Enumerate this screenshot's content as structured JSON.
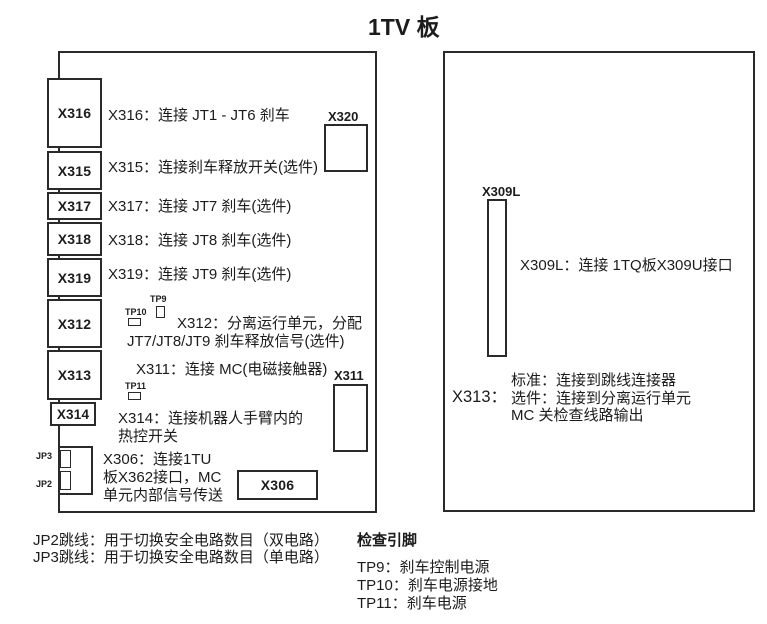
{
  "title": "1TV 板",
  "colors": {
    "line": "#2a2a2a",
    "text": "#1c1c1c",
    "background": "#ffffff"
  },
  "left_board": {
    "edge_connectors": [
      "X316",
      "X315",
      "X317",
      "X318",
      "X319",
      "X312",
      "X313",
      "X314"
    ],
    "other_connectors": [
      "X320",
      "X311",
      "X306"
    ],
    "descriptions": {
      "x316": "X316：连接 JT1 - JT6 刹车",
      "x315": "X315：连接刹车释放开关(选件)",
      "x317": "X317：连接 JT7 刹车(选件)",
      "x318": "X318：连接 JT8 刹车(选件)",
      "x319": "X319：连接 JT9 刹车(选件)",
      "x312_line1": "X312：分离运行单元，分配",
      "x312_line2": "JT7/JT8/JT9 刹车释放信号(选件)",
      "x311": "X311：连接 MC(电磁接触器)",
      "x314_line1": "X314：连接机器人手臂内的",
      "x314_line2": "热控开关",
      "x306_line1": "X306：连接1TU",
      "x306_line2": "板X362接口，MC",
      "x306_line3": "单元内部信号传送"
    },
    "test_points": [
      "TP9",
      "TP10",
      "TP11"
    ],
    "jumpers": [
      "JP3",
      "JP2"
    ]
  },
  "right_board": {
    "connector": "X309L",
    "x309l_description": "X309L：连接 1TQ板X309U接口",
    "x313_label": "X313：",
    "x313_line1": "标准：连接到跳线连接器",
    "x313_line2": "选件：连接到分离运行单元",
    "x313_line3": "MC 关检查线路输出"
  },
  "footnotes": {
    "jp2": "JP2跳线：用于切换安全电路数目（双电路）",
    "jp3": "JP3跳线：用于切换安全电路数目（单电路）",
    "check_pins_title": "检查引脚",
    "tp9": "TP9：刹车控制电源",
    "tp10": "TP10：刹车电源接地",
    "tp11": "TP11：刹车电源"
  }
}
